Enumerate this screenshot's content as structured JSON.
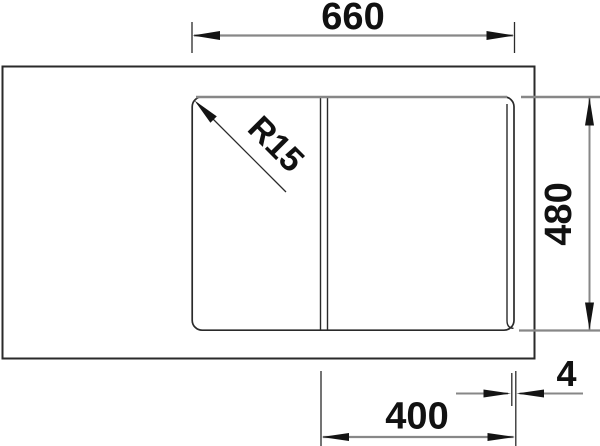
{
  "drawing": {
    "type": "technical-dimension-drawing",
    "subject": "kitchen-sink-top-view",
    "labels": {
      "top_width": "660",
      "right_height": "480",
      "bottom_bowl_width": "400",
      "bottom_edge_gap": "4",
      "corner_radius": "R15"
    },
    "colors": {
      "outline": "#2a2a2a",
      "dimension_line": "#878787",
      "label_text": "#111111",
      "background": "#ffffff"
    }
  }
}
